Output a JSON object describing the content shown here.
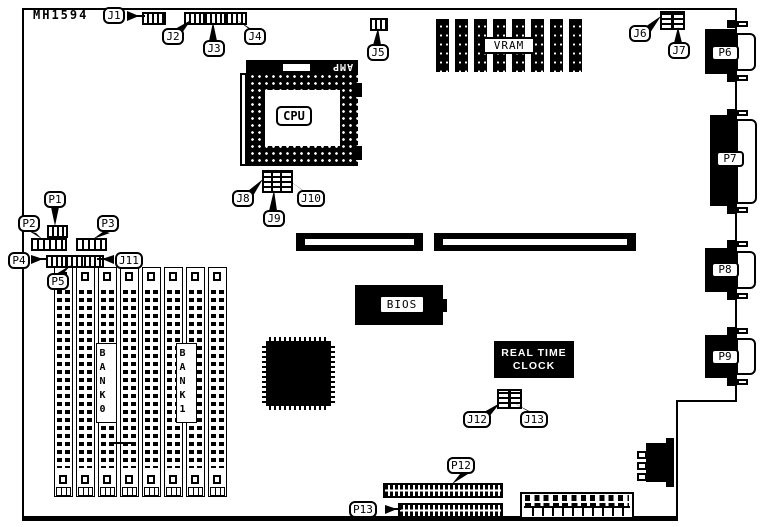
{
  "board": {
    "id": "MH1594"
  },
  "chips": {
    "cpu": {
      "label": "CPU",
      "socket_brand": "AMP"
    },
    "vram": {
      "label": "VRAM",
      "chip_count": 8
    },
    "bios": {
      "label": "BIOS"
    },
    "rtc": {
      "line1": "REAL TIME",
      "line2": "CLOCK"
    }
  },
  "memory": {
    "simm_count": 8,
    "banks": [
      {
        "label": "BANK0"
      },
      {
        "label": "BANK1"
      }
    ]
  },
  "jumpers": {
    "j1": "J1",
    "j2": "J2",
    "j3": "J3",
    "j4": "J4",
    "j5": "J5",
    "j6": "J6",
    "j7": "J7",
    "j8": "J8",
    "j9": "J9",
    "j10": "J10",
    "j11": "J11",
    "j12": "J12",
    "j13": "J13"
  },
  "ports": {
    "p1": "P1",
    "p2": "P2",
    "p3": "P3",
    "p4": "P4",
    "p5": "P5",
    "p6": "P6",
    "p7": "P7",
    "p8": "P8",
    "p9": "P9",
    "p12": "P12",
    "p13": "P13"
  },
  "colors": {
    "fg": "#000000",
    "bg": "#ffffff"
  }
}
